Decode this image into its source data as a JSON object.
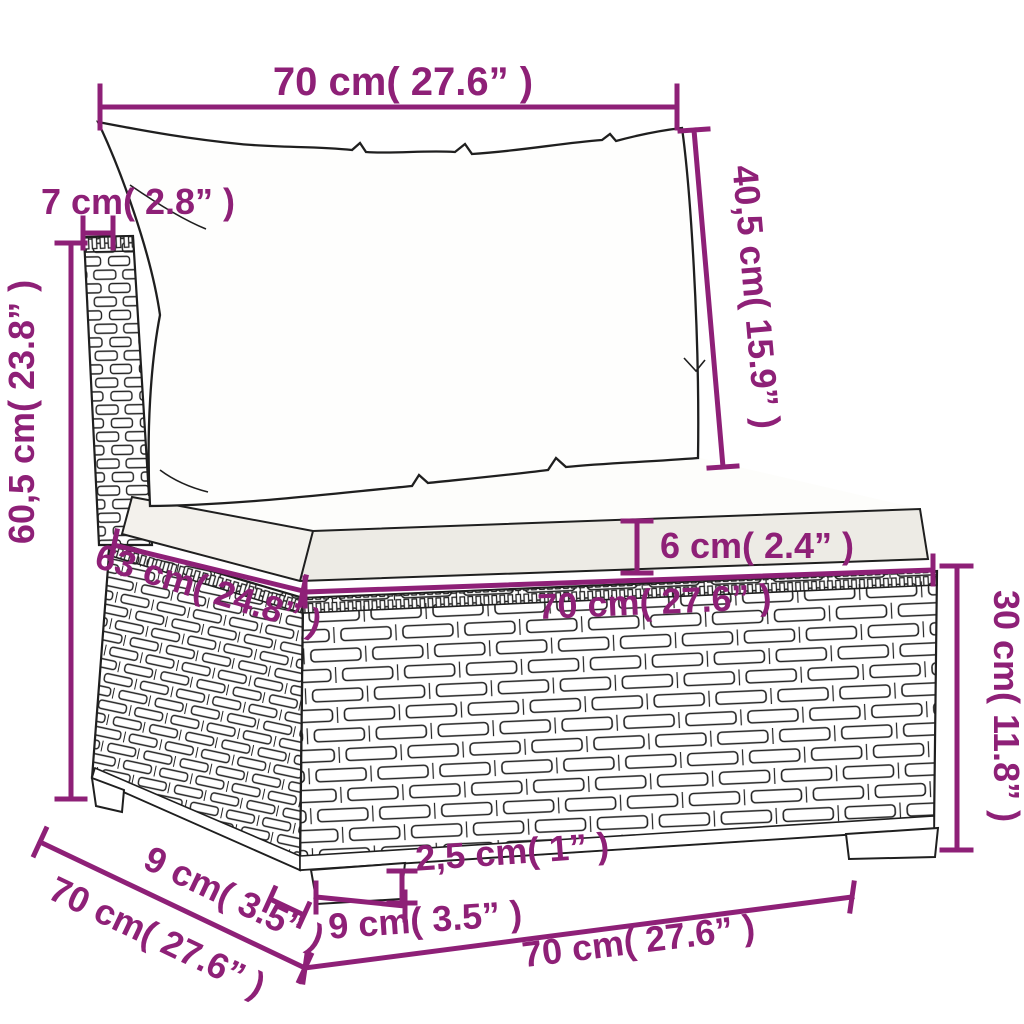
{
  "diagram": {
    "product": "poly-rattan-sofa-middle-section-with-cushions",
    "colors": {
      "dimension_accent": "#8e2077",
      "line_art": "#1f1f1f",
      "background": "#ffffff",
      "cushion_front_shade": "#edebe5",
      "cushion_side_shade": "#f3f1ec"
    },
    "dimensions": {
      "back_width_top": {
        "label": "70 cm( 27.6” )",
        "cm": "70",
        "inches": "27.6"
      },
      "back_thickness": {
        "label": "7 cm( 2.8” )",
        "cm": "7",
        "inches": "2.8"
      },
      "back_cushion_height": {
        "label": "40,5 cm( 15.9” )",
        "cm": "40,5",
        "inches": "15.9"
      },
      "total_height": {
        "label": "60,5 cm( 23.8” )",
        "cm": "60,5",
        "inches": "23.8"
      },
      "seat_depth": {
        "label": "63 cm( 24.8” )",
        "cm": "63",
        "inches": "24.8"
      },
      "seat_cushion_thickness": {
        "label": "6 cm( 2.4” )",
        "cm": "6",
        "inches": "2.4"
      },
      "seat_width": {
        "label": "70 cm( 27.6” )",
        "cm": "70",
        "inches": "27.6"
      },
      "base_height": {
        "label": "30 cm( 11.8” )",
        "cm": "30",
        "inches": "11.8"
      },
      "base_depth": {
        "label": "70 cm( 27.6” )",
        "cm": "70",
        "inches": "27.6"
      },
      "leg_depth": {
        "label": "9 cm( 3.5” )",
        "cm": "9",
        "inches": "3.5"
      },
      "leg_height": {
        "label": "2,5 cm( 1” )",
        "cm": "2,5",
        "inches": "1"
      },
      "leg_width": {
        "label": "9 cm( 3.5” )",
        "cm": "9",
        "inches": "3.5"
      },
      "base_width": {
        "label": "70 cm( 27.6” )",
        "cm": "70",
        "inches": "27.6"
      }
    }
  }
}
